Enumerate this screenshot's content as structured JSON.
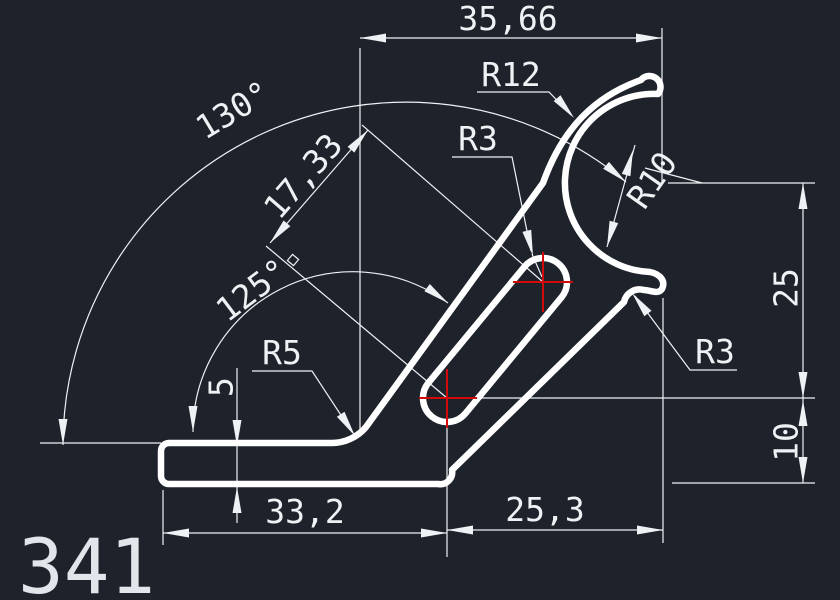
{
  "drawing": {
    "part_number": "341",
    "colors": {
      "background": "#1e222a",
      "geometry": "#ffffff",
      "dimensions": "#eef2f5",
      "center_mark": "#d40909"
    },
    "dimensions": {
      "top_width": "35,66",
      "outer_angle": "130°",
      "inner_angle": "125°",
      "slot_length": "17,33",
      "right_upper": "25",
      "right_lower": "10",
      "base_length": "33,2",
      "bottom_right_length": "25,3",
      "thickness": "5"
    },
    "radii": {
      "top": "R12",
      "slot": "R3",
      "bore": "R10",
      "fillet": "R5",
      "notch": "R3"
    }
  }
}
